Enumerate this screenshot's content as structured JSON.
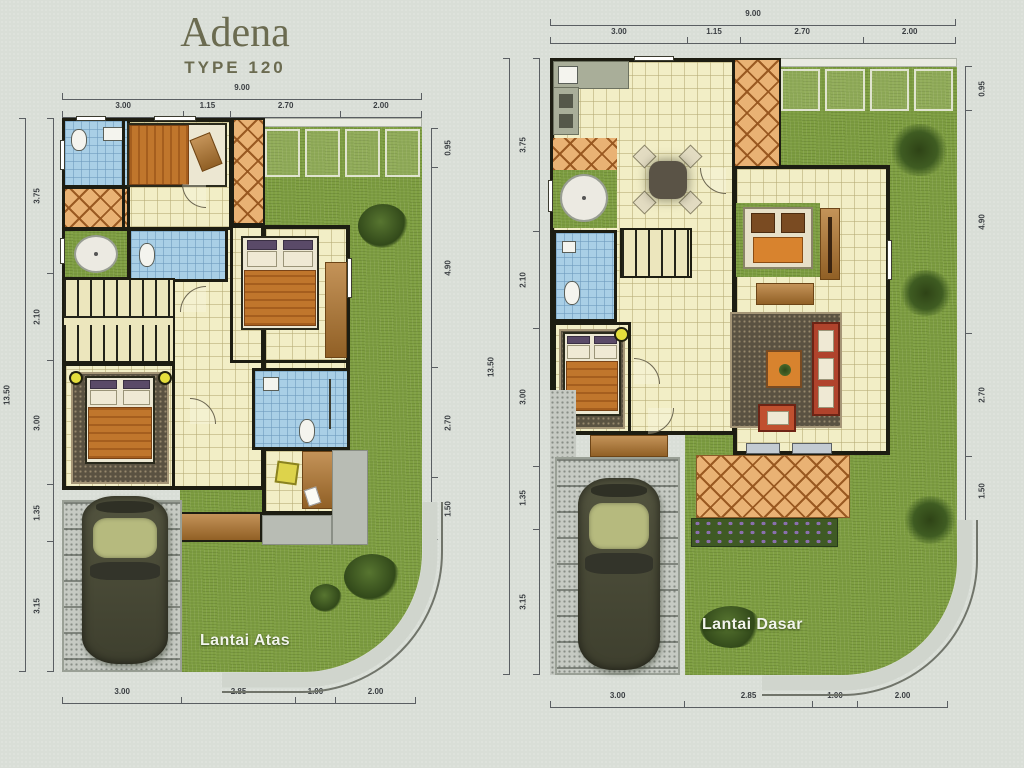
{
  "title": {
    "name": "Adena",
    "type": "TYPE 120"
  },
  "plans": {
    "upper": {
      "label": "Lantai Atas",
      "dims": {
        "top_overall": "9.00",
        "top": [
          "3.00",
          "1.15",
          "2.70",
          "2.00"
        ],
        "left_overall": "13.50",
        "left": [
          "3.75",
          "2.10",
          "3.00",
          "1.35",
          "3.15"
        ],
        "right": [
          "0.95",
          "4.90",
          "2.70",
          "1.50"
        ],
        "bottom": [
          "3.00",
          "2.85",
          "1.00",
          "2.00"
        ]
      }
    },
    "ground": {
      "label": "Lantai Dasar",
      "dims": {
        "top_overall": "9.00",
        "top": [
          "3.00",
          "1.15",
          "2.70",
          "2.00"
        ],
        "left_overall": "13.50",
        "left": [
          "3.75",
          "2.10",
          "3.00",
          "1.35",
          "3.15"
        ],
        "right": [
          "0.95",
          "4.90",
          "2.70",
          "1.50"
        ],
        "bottom": [
          "3.00",
          "2.85",
          "1.00",
          "2.00"
        ]
      }
    }
  },
  "colors": {
    "background": "#d9ded7",
    "grass": "#7f9f42",
    "floor_cream": "#f2eec6",
    "bath_blue": "#a9cfe6",
    "terracotta": "#e9b274",
    "wall_black": "#1d1d12",
    "wood_brown": "#b5782f",
    "bed_orange": "#c0762c",
    "sofa_red": "#b0432c",
    "paver_gray": "#c6cac3",
    "title_olive": "#6b6b50",
    "label_white": "#f2f4ec"
  }
}
